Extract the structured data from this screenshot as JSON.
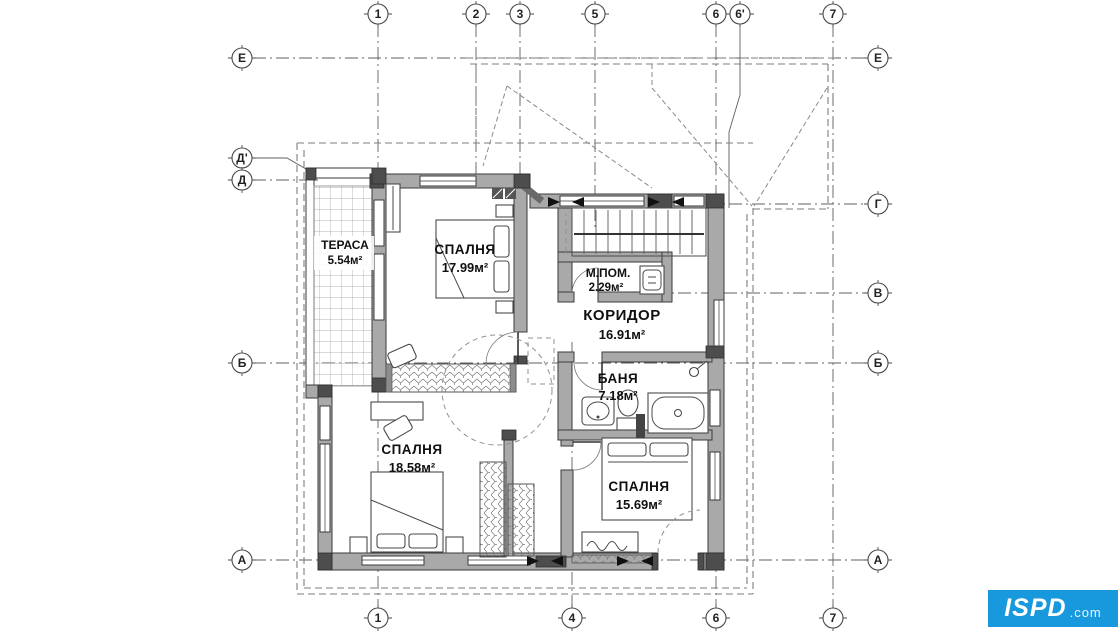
{
  "axes": {
    "top": [
      {
        "label": "1"
      },
      {
        "label": "2"
      },
      {
        "label": "3"
      },
      {
        "label": "5"
      },
      {
        "label": "6"
      },
      {
        "label": "6'"
      },
      {
        "label": "7"
      }
    ],
    "bottom": [
      {
        "label": "1"
      },
      {
        "label": "4"
      },
      {
        "label": "6"
      },
      {
        "label": "7"
      }
    ],
    "left": [
      {
        "label": "Е"
      },
      {
        "label": "Д'"
      },
      {
        "label": "Д"
      },
      {
        "label": "Б"
      },
      {
        "label": "А"
      }
    ],
    "right": [
      {
        "label": "Е"
      },
      {
        "label": "Г"
      },
      {
        "label": "В"
      },
      {
        "label": "Б"
      },
      {
        "label": "А"
      }
    ]
  },
  "rooms": {
    "terrace": {
      "name": "ТЕРАСА",
      "area": "5.54м²"
    },
    "bedroom_top": {
      "name": "СПАЛНЯ",
      "area": "17.99м²"
    },
    "utility": {
      "name": "М.ПОМ.",
      "area": "2.29м²"
    },
    "corridor": {
      "name": "КОРИДОР",
      "area": "16.91м²"
    },
    "bathroom": {
      "name": "БАНЯ",
      "area": "7.18м²"
    },
    "bedroom_left": {
      "name": "СПАЛНЯ",
      "area": "18.58м²"
    },
    "bedroom_right": {
      "name": "СПАЛНЯ",
      "area": "15.69м²"
    }
  },
  "watermark": {
    "text": "ISPD",
    "suffix": ".com",
    "background": "#1898dd"
  }
}
